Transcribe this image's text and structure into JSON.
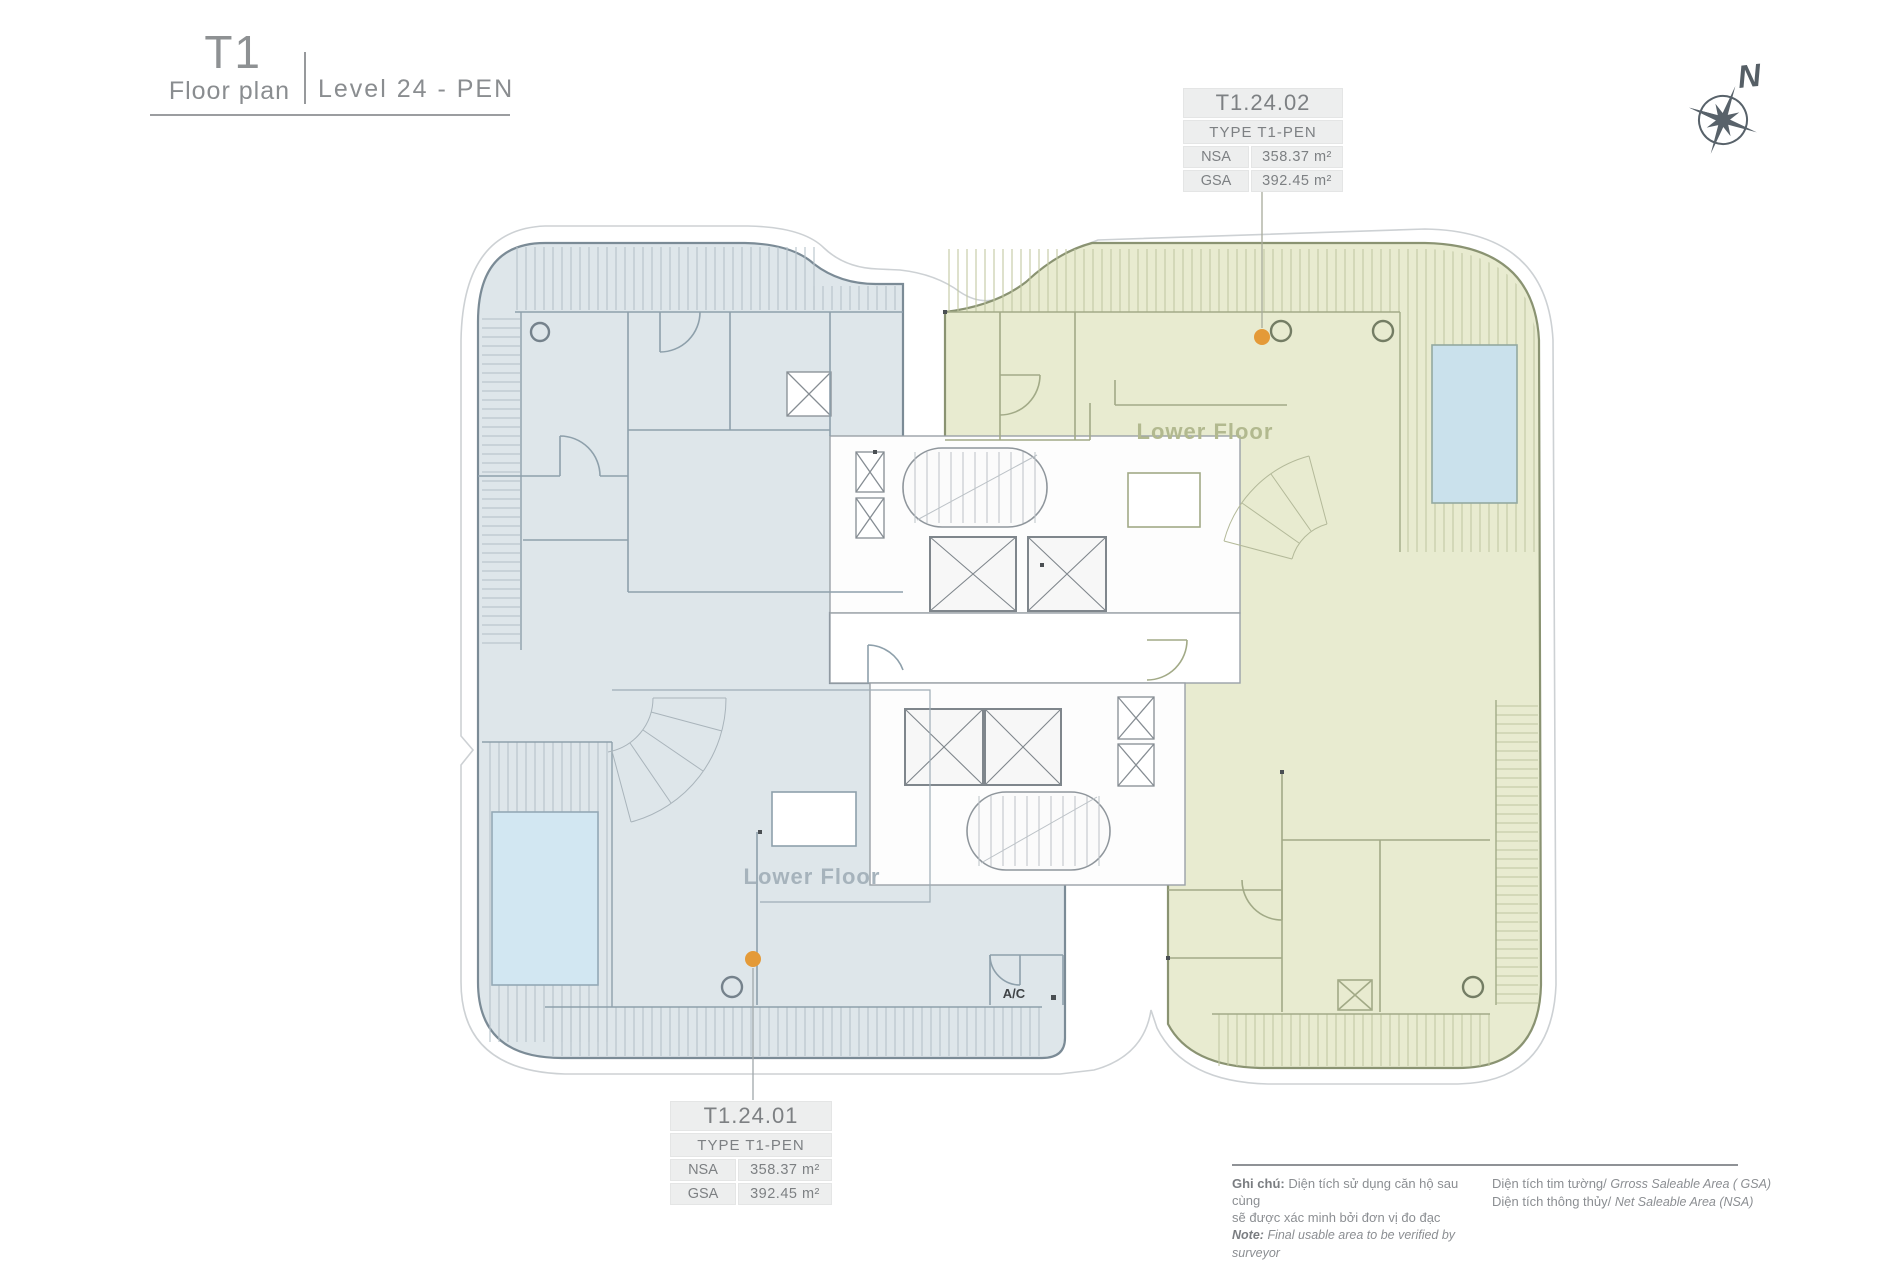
{
  "header": {
    "tower": "T1",
    "subtitle": "Floor plan",
    "level_label": "Level 24 - PEN"
  },
  "compass": {
    "north_label": "N"
  },
  "callouts": [
    {
      "unit_id": "T1.24.02",
      "type_label": "TYPE T1-PEN",
      "nsa_label": "NSA",
      "nsa_value": "358.37 m²",
      "gsa_label": "GSA",
      "gsa_value": "392.45 m²"
    },
    {
      "unit_id": "T1.24.01",
      "type_label": "TYPE T1-PEN",
      "nsa_label": "NSA",
      "nsa_value": "358.37 m²",
      "gsa_label": "GSA",
      "gsa_value": "392.45 m²"
    }
  ],
  "plan": {
    "lower_floor_label": "Lower Floor",
    "ac_label": "A/C"
  },
  "notes": {
    "left": {
      "label": "Ghi chú:",
      "line1": "Diện tích sử dụng căn hộ sau cùng",
      "line2": "sẽ được xác minh bởi đơn vị đo đạc",
      "note_label": "Note:",
      "note_text": "Final usable area to be verified by surveyor"
    },
    "right": {
      "row1_vn": "Diện tích tim tường/",
      "row1_en": "Grross Saleable Area ( GSA)",
      "row2_vn": "Diện tích thông thủy/",
      "row2_en": "Net Saleable Area (NSA)"
    }
  },
  "colors": {
    "unit_01_fill": "#dee6ea",
    "unit_02_fill": "#e8ebd0",
    "pool_fill": "#cfe4f0",
    "marker_orange": "#e49a38"
  }
}
